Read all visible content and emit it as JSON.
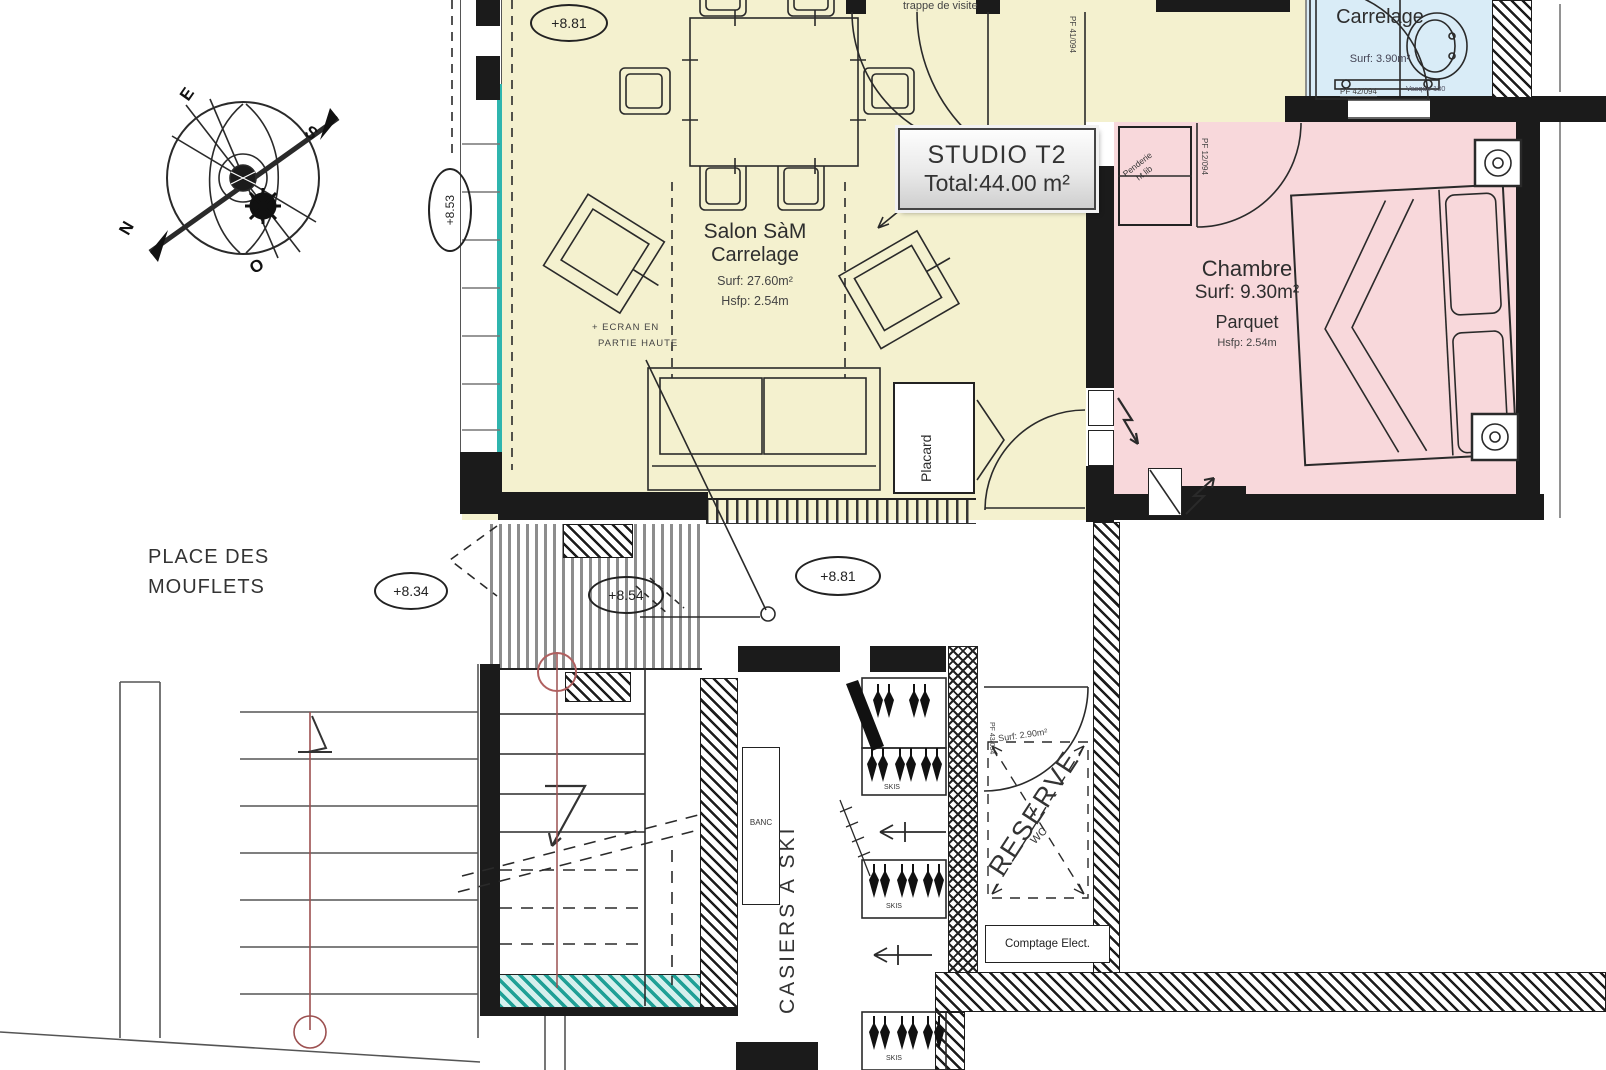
{
  "title_block": {
    "line1": "STUDIO T2",
    "line2": "Total:44.00 m²"
  },
  "compass": {
    "n": "N",
    "s": "S",
    "e": "E",
    "o": "O"
  },
  "salon": {
    "name": "Salon SàM",
    "floor": "Carrelage",
    "surface": "Surf: 27.60m²",
    "height": "Hsfp: 2.54m",
    "ecran_line1": "+ ECRAN EN",
    "ecran_line2": "PARTIE HAUTE",
    "placard": "Placard",
    "trappe": "trappe de visite"
  },
  "chambre": {
    "name": "Chambre",
    "surface": "Surf: 9.30m²",
    "floor": "Parquet",
    "height": "Hsfp: 2.54m",
    "penderie_line1": "Penderie",
    "penderie_line2": "ht lib",
    "door": "PF 12/094"
  },
  "sdb": {
    "floor": "Carrelage",
    "surface": "Surf: 3.90m²",
    "door": "PF 42/094",
    "vasque": "Vasque 130"
  },
  "entry": {
    "door": "PF 41/094"
  },
  "reserve": {
    "name": "RESERVE",
    "surface": "Surf: 2.90m²",
    "wc": "WC",
    "door": "PF 43/094",
    "comptage": "Comptage Elect."
  },
  "casiers": {
    "name": "CASIERS A SKI",
    "skis": "SKIS",
    "banc": "BANC"
  },
  "exterior": {
    "place_line1": "PLACE DES",
    "place_line2": "MOUFLETS"
  },
  "levels": {
    "salon": "+8.81",
    "balcon": "+8.53",
    "place": "+8.34",
    "deck": "+8.54",
    "corridor": "+8.81"
  },
  "colors": {
    "salon_fill": "#f4f1cf",
    "chambre_fill": "#f8d8db",
    "sdb_fill": "#d9ecf7",
    "glazing": "#2fb5ae",
    "wall": "#1b1b1b",
    "stair_line": "#9c5050"
  }
}
